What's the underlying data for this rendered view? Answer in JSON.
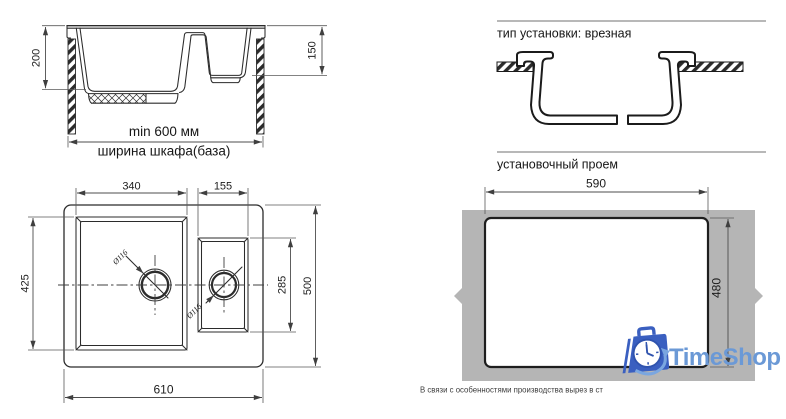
{
  "side_view": {
    "depth_main": "200",
    "depth_small": "150",
    "min_width": "min 600 мм",
    "cabinet_label": "ширина шкафа(база)"
  },
  "top_view": {
    "main_width": "340",
    "small_width": "155",
    "main_depth": "425",
    "small_depth": "285",
    "total_depth": "500",
    "total_width": "610",
    "main_drain": "Ø116",
    "small_drain": "Ø116"
  },
  "installation_section": {
    "title": "тип установки: врезная"
  },
  "opening_section": {
    "title": "установочный проем",
    "width": "590",
    "height": "480"
  },
  "footnote": "В связи с особенностями производства вырез в ст",
  "logo": {
    "text": "TimeShop",
    "colors": {
      "text": "#6b99d6",
      "bag": "#3a5fc0",
      "clock_line": "#2f53ae",
      "accent": "#7aa6e0"
    }
  },
  "palette": {
    "line": "#2b2b2b",
    "dimension": "#4c4c4c",
    "countertop": "#b5b5b5"
  }
}
